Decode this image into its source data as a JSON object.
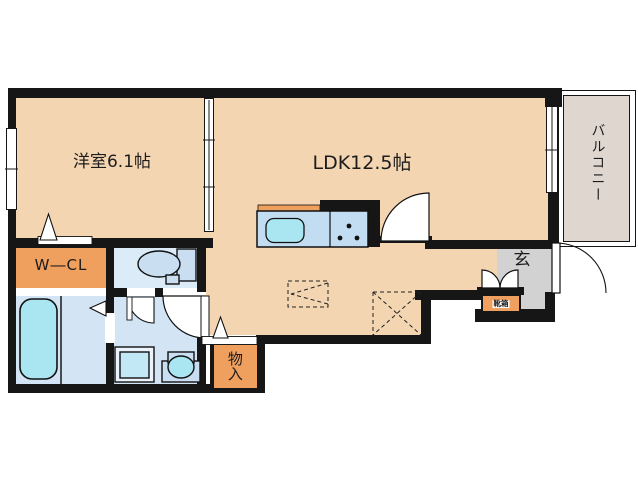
{
  "title": "apartment-floor-plan",
  "colors": {
    "wall": "#161616",
    "floor": "#f4d5b2",
    "orange": "#f0a05e",
    "bathblue": "#d3e4f4",
    "toiletblue": "#dcebf8",
    "fixture": "#c9def1",
    "aqua": "#a9e6f2",
    "counter": "#c2ddf2",
    "wminner": "#c2e7f5",
    "genkan": "#d2d2d2",
    "balcony": "#ded6cf",
    "line": "#1a1a1a"
  },
  "rooms": [
    {
      "id": "western-room",
      "label": "洋室6.1帖"
    },
    {
      "id": "ldk",
      "label": "LDK12.5帖"
    },
    {
      "id": "walk-in-closet",
      "label": "W―CL"
    },
    {
      "id": "storage",
      "label": "物入"
    },
    {
      "id": "entrance",
      "label": "玄"
    },
    {
      "id": "shoe-box",
      "label": "靴箱"
    },
    {
      "id": "balcony",
      "label": "バルコニー"
    }
  ]
}
